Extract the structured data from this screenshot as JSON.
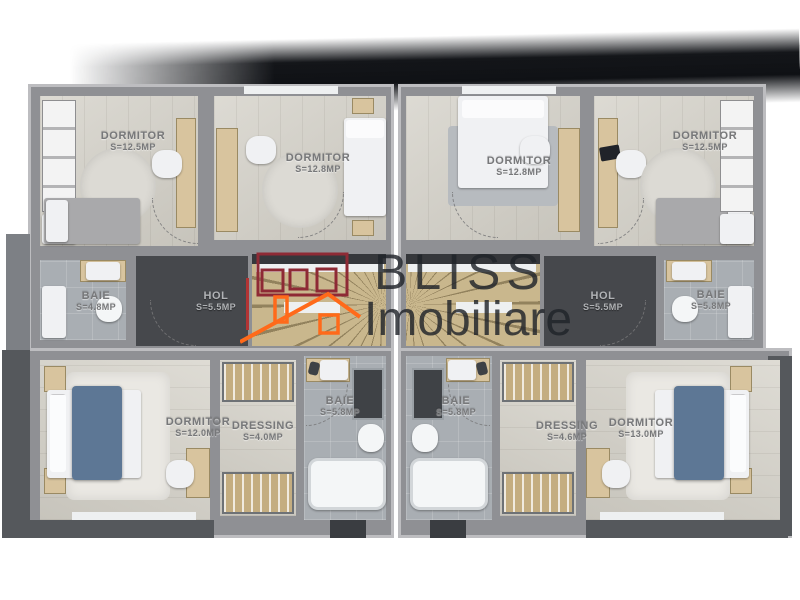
{
  "brand": {
    "line1": "BLISS",
    "line2": "Imobiliare"
  },
  "logo": {
    "icon": "house-roof-icon",
    "orange": "#ff6a1a",
    "red": "#8e2a35"
  },
  "plan": {
    "rooms": [
      {
        "id": "dormitor-top-left",
        "name": "DORMITOR",
        "area": "S=12.5MP"
      },
      {
        "id": "dormitor-top-center-left",
        "name": "DORMITOR",
        "area": "S=12.8MP"
      },
      {
        "id": "baie-mid-left",
        "name": "BAIE",
        "area": "S=4.8MP"
      },
      {
        "id": "hol-left",
        "name": "HOL",
        "area": "S=5.5MP"
      },
      {
        "id": "dormitor-bottom-left",
        "name": "DORMITOR",
        "area": "S=12.0MP"
      },
      {
        "id": "dressing-left",
        "name": "DRESSING",
        "area": "S=4.0MP"
      },
      {
        "id": "baie-bottom-left",
        "name": "BAIE",
        "area": "S=5.8MP"
      },
      {
        "id": "dormitor-top-center-right",
        "name": "DORMITOR",
        "area": "S=12.8MP"
      },
      {
        "id": "dormitor-top-right",
        "name": "DORMITOR",
        "area": "S=12.5MP"
      },
      {
        "id": "baie-mid-right",
        "name": "BAIE",
        "area": "S=5.8MP"
      },
      {
        "id": "hol-right",
        "name": "HOL",
        "area": "S=5.5MP"
      },
      {
        "id": "baie-bottom-right",
        "name": "BAIE",
        "area": "S=5.8MP"
      },
      {
        "id": "dressing-right",
        "name": "DRESSING",
        "area": "S=4.6MP"
      },
      {
        "id": "dormitor-bottom-right",
        "name": "DORMITOR",
        "area": "S=13.0MP"
      }
    ]
  },
  "colors": {
    "wall": "#8f9094",
    "wood_floor": "#d3d0c7",
    "tile_floor": "#a9aeb3",
    "hol_floor": "#46484c",
    "stairs": "#c9b78d",
    "bed_duvet": "#5d7795"
  }
}
